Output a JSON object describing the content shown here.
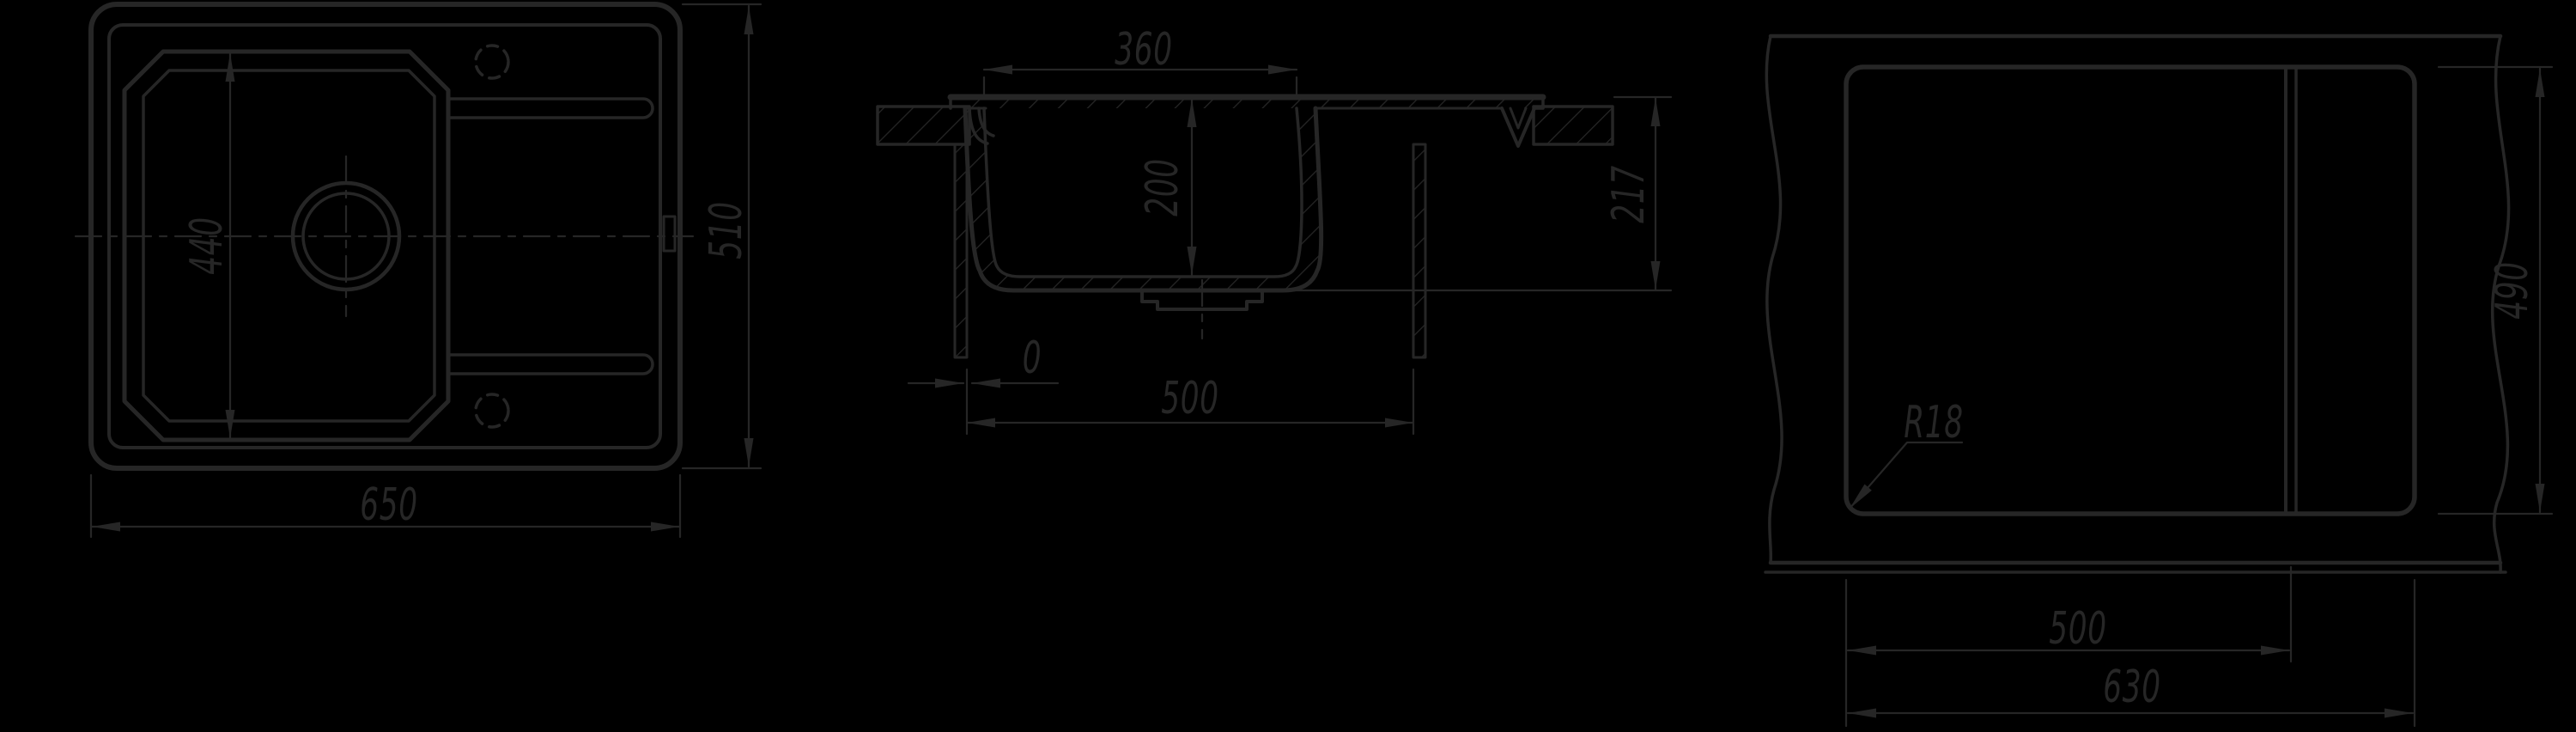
{
  "canvas": {
    "background": "#000000",
    "line": "#262626"
  },
  "views": {
    "plan": {
      "dim_basin_length": "440",
      "dim_overall_width": "510",
      "dim_overall_length": "650"
    },
    "section": {
      "dim_bowl_top_width": "360",
      "dim_bowl_depth": "200",
      "dim_overall_depth": "217",
      "dim_edge_gap": "0",
      "dim_cabinet_width": "500"
    },
    "cutout": {
      "dim_cutout_depth": "490",
      "dim_corner_radius": "R18",
      "dim_divider_offset": "500",
      "dim_cutout_width": "630"
    }
  }
}
